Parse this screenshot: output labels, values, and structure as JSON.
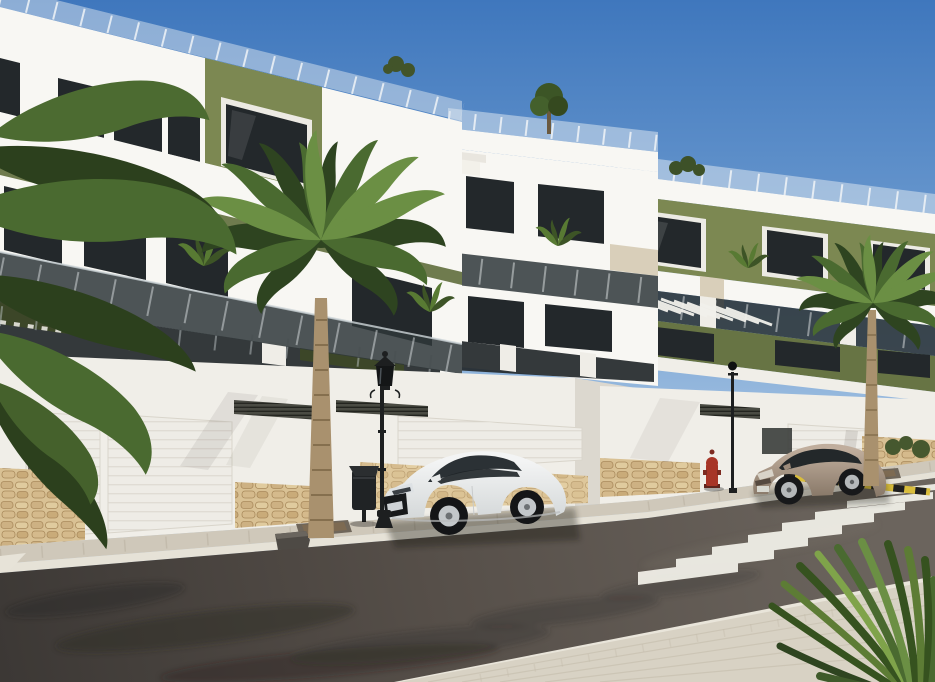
{
  "meta": {
    "type": "architectural-render",
    "scene": "Sunny street view of a modern new-build apartment complex with parked cars, palm trees and a zebra crossing"
  },
  "palette": {
    "sky_top": "#3f77bd",
    "sky_mid": "#6e9cd0",
    "sky_low": "#a9c6e4",
    "sky_horizon": "#e2ecf5",
    "wall_white": "#f0eee8",
    "wall_bright": "#f8f7f3",
    "wall_shade": "#dcd8cf",
    "olive": "#7c8852",
    "olive_dark": "#677444",
    "olive_deep": "#3c4628",
    "fascia_beige": "#d9cfba",
    "glass_dark": "#23282b",
    "glass_rail": "#2f373a",
    "stone": "#d9c194",
    "road_dark": "#3c3835",
    "road_mid": "#564f49",
    "road_light": "#6b645d",
    "sidewalk_far": "#cfc8ba",
    "sidewalk_near": "#d8d2c4",
    "crosswalk": "#f3f1ea",
    "palm_dark": "#2e4420",
    "palm_mid": "#4a6a30",
    "palm_light": "#6b8f44",
    "trunk": "#a9916e",
    "trunk_dark": "#7d6747",
    "car_white": "#f3f4f4",
    "car_white_shade": "#d4d8d9",
    "car_bronze": "#c0ae9d",
    "car_bronze_shade": "#887868",
    "black_metal": "#1d1f20",
    "hydrant_red": "#a73527",
    "curb_yellow": "#d9bd3c"
  },
  "objects": {
    "buildings": {
      "storeys": 3,
      "style": "white render with olive-green accent panels, dark glazing, glass balustrades",
      "blocks": [
        "left block",
        "middle block",
        "right block"
      ]
    },
    "street_wall": {
      "garage_doors": 4,
      "louvre_vents": 4,
      "stone_base_sections": 5
    },
    "crosswalk": {
      "stripes": 8
    },
    "vehicles": {
      "white_coupe": {
        "label": "white coupe parked facing left"
      },
      "bronze_coupe": {
        "label": "bronze coupe parked facing left"
      }
    },
    "street_furniture": {
      "lamp_posts": 2,
      "litter_bin": 1,
      "fire_hydrant": 1,
      "no_parking_curb": "yellow-black"
    },
    "vegetation": {
      "large_palm": 1,
      "right_palm": 1,
      "corner_fronds": "overhanging top-left",
      "foreground_plant": "spiky shrub bottom-right"
    }
  }
}
